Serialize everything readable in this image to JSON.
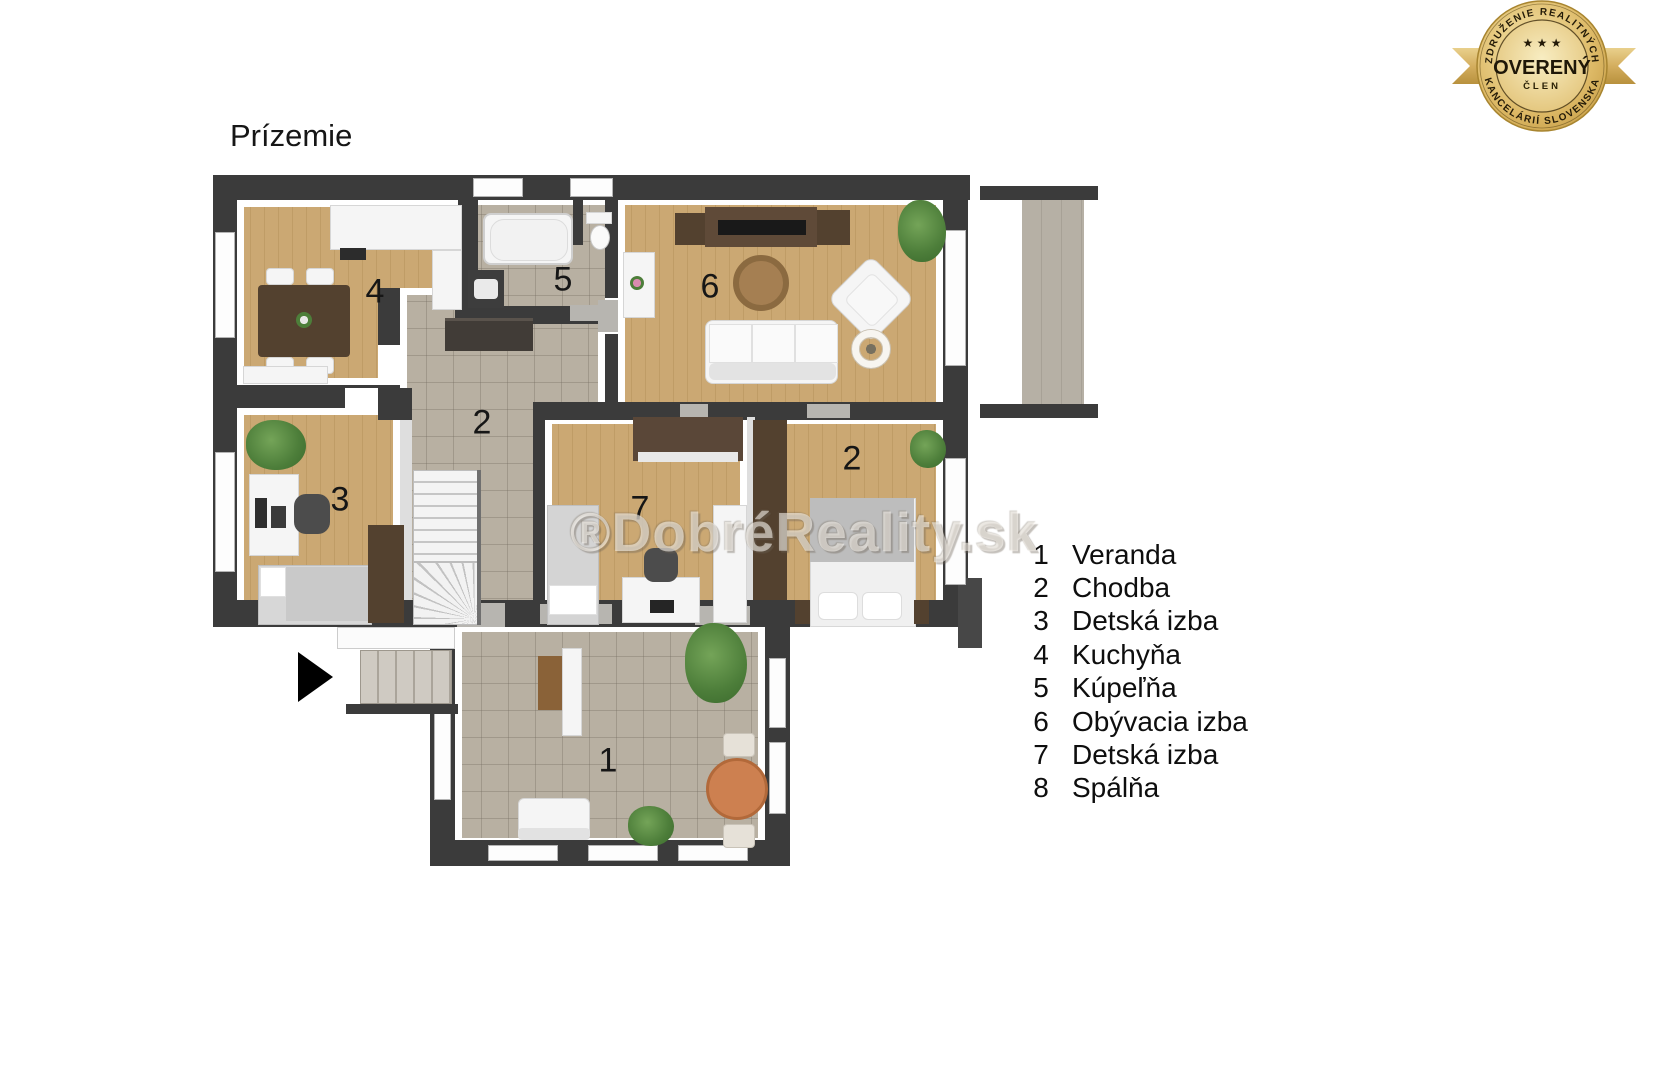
{
  "title": "Prízemie",
  "watermark": "®DobréReality.sk",
  "badge": {
    "arc_top": "ZDRUŽENIE REALITNÝCH",
    "arc_bottom": "KANCELÁRIÍ SLOVENSKA",
    "stars": "★ ★ ★",
    "main": "OVERENÝ",
    "sub": "ČLEN"
  },
  "legend": {
    "items": [
      {
        "number": "1",
        "label": "Veranda"
      },
      {
        "number": "2",
        "label": "Chodba"
      },
      {
        "number": "3",
        "label": "Detská izba"
      },
      {
        "number": "4",
        "label": "Kuchyňa"
      },
      {
        "number": "5",
        "label": "Kúpeľňa"
      },
      {
        "number": "6",
        "label": "Obývacia izba"
      },
      {
        "number": "7",
        "label": "Detská izba"
      },
      {
        "number": "8",
        "label": "Spálňa"
      }
    ]
  },
  "plan": {
    "markers": [
      {
        "n": "4",
        "x": 375,
        "y": 292
      },
      {
        "n": "5",
        "x": 563,
        "y": 280
      },
      {
        "n": "6",
        "x": 710,
        "y": 287
      },
      {
        "n": "2",
        "x": 482,
        "y": 423
      },
      {
        "n": "3",
        "x": 340,
        "y": 500
      },
      {
        "n": "7",
        "x": 640,
        "y": 509
      },
      {
        "n": "2",
        "x": 852,
        "y": 459
      },
      {
        "n": "1",
        "x": 608,
        "y": 761
      }
    ]
  },
  "colors": {
    "wall": "#3b3b3b",
    "wood_floor": "#cba873",
    "tile_floor": "#b8b0a2",
    "deck": "#b0aa9f",
    "badge_gold": "#d4ae5e",
    "badge_text": "#2a2005",
    "dark_furniture": "#53412f",
    "veranda_table": "#cd8050"
  }
}
